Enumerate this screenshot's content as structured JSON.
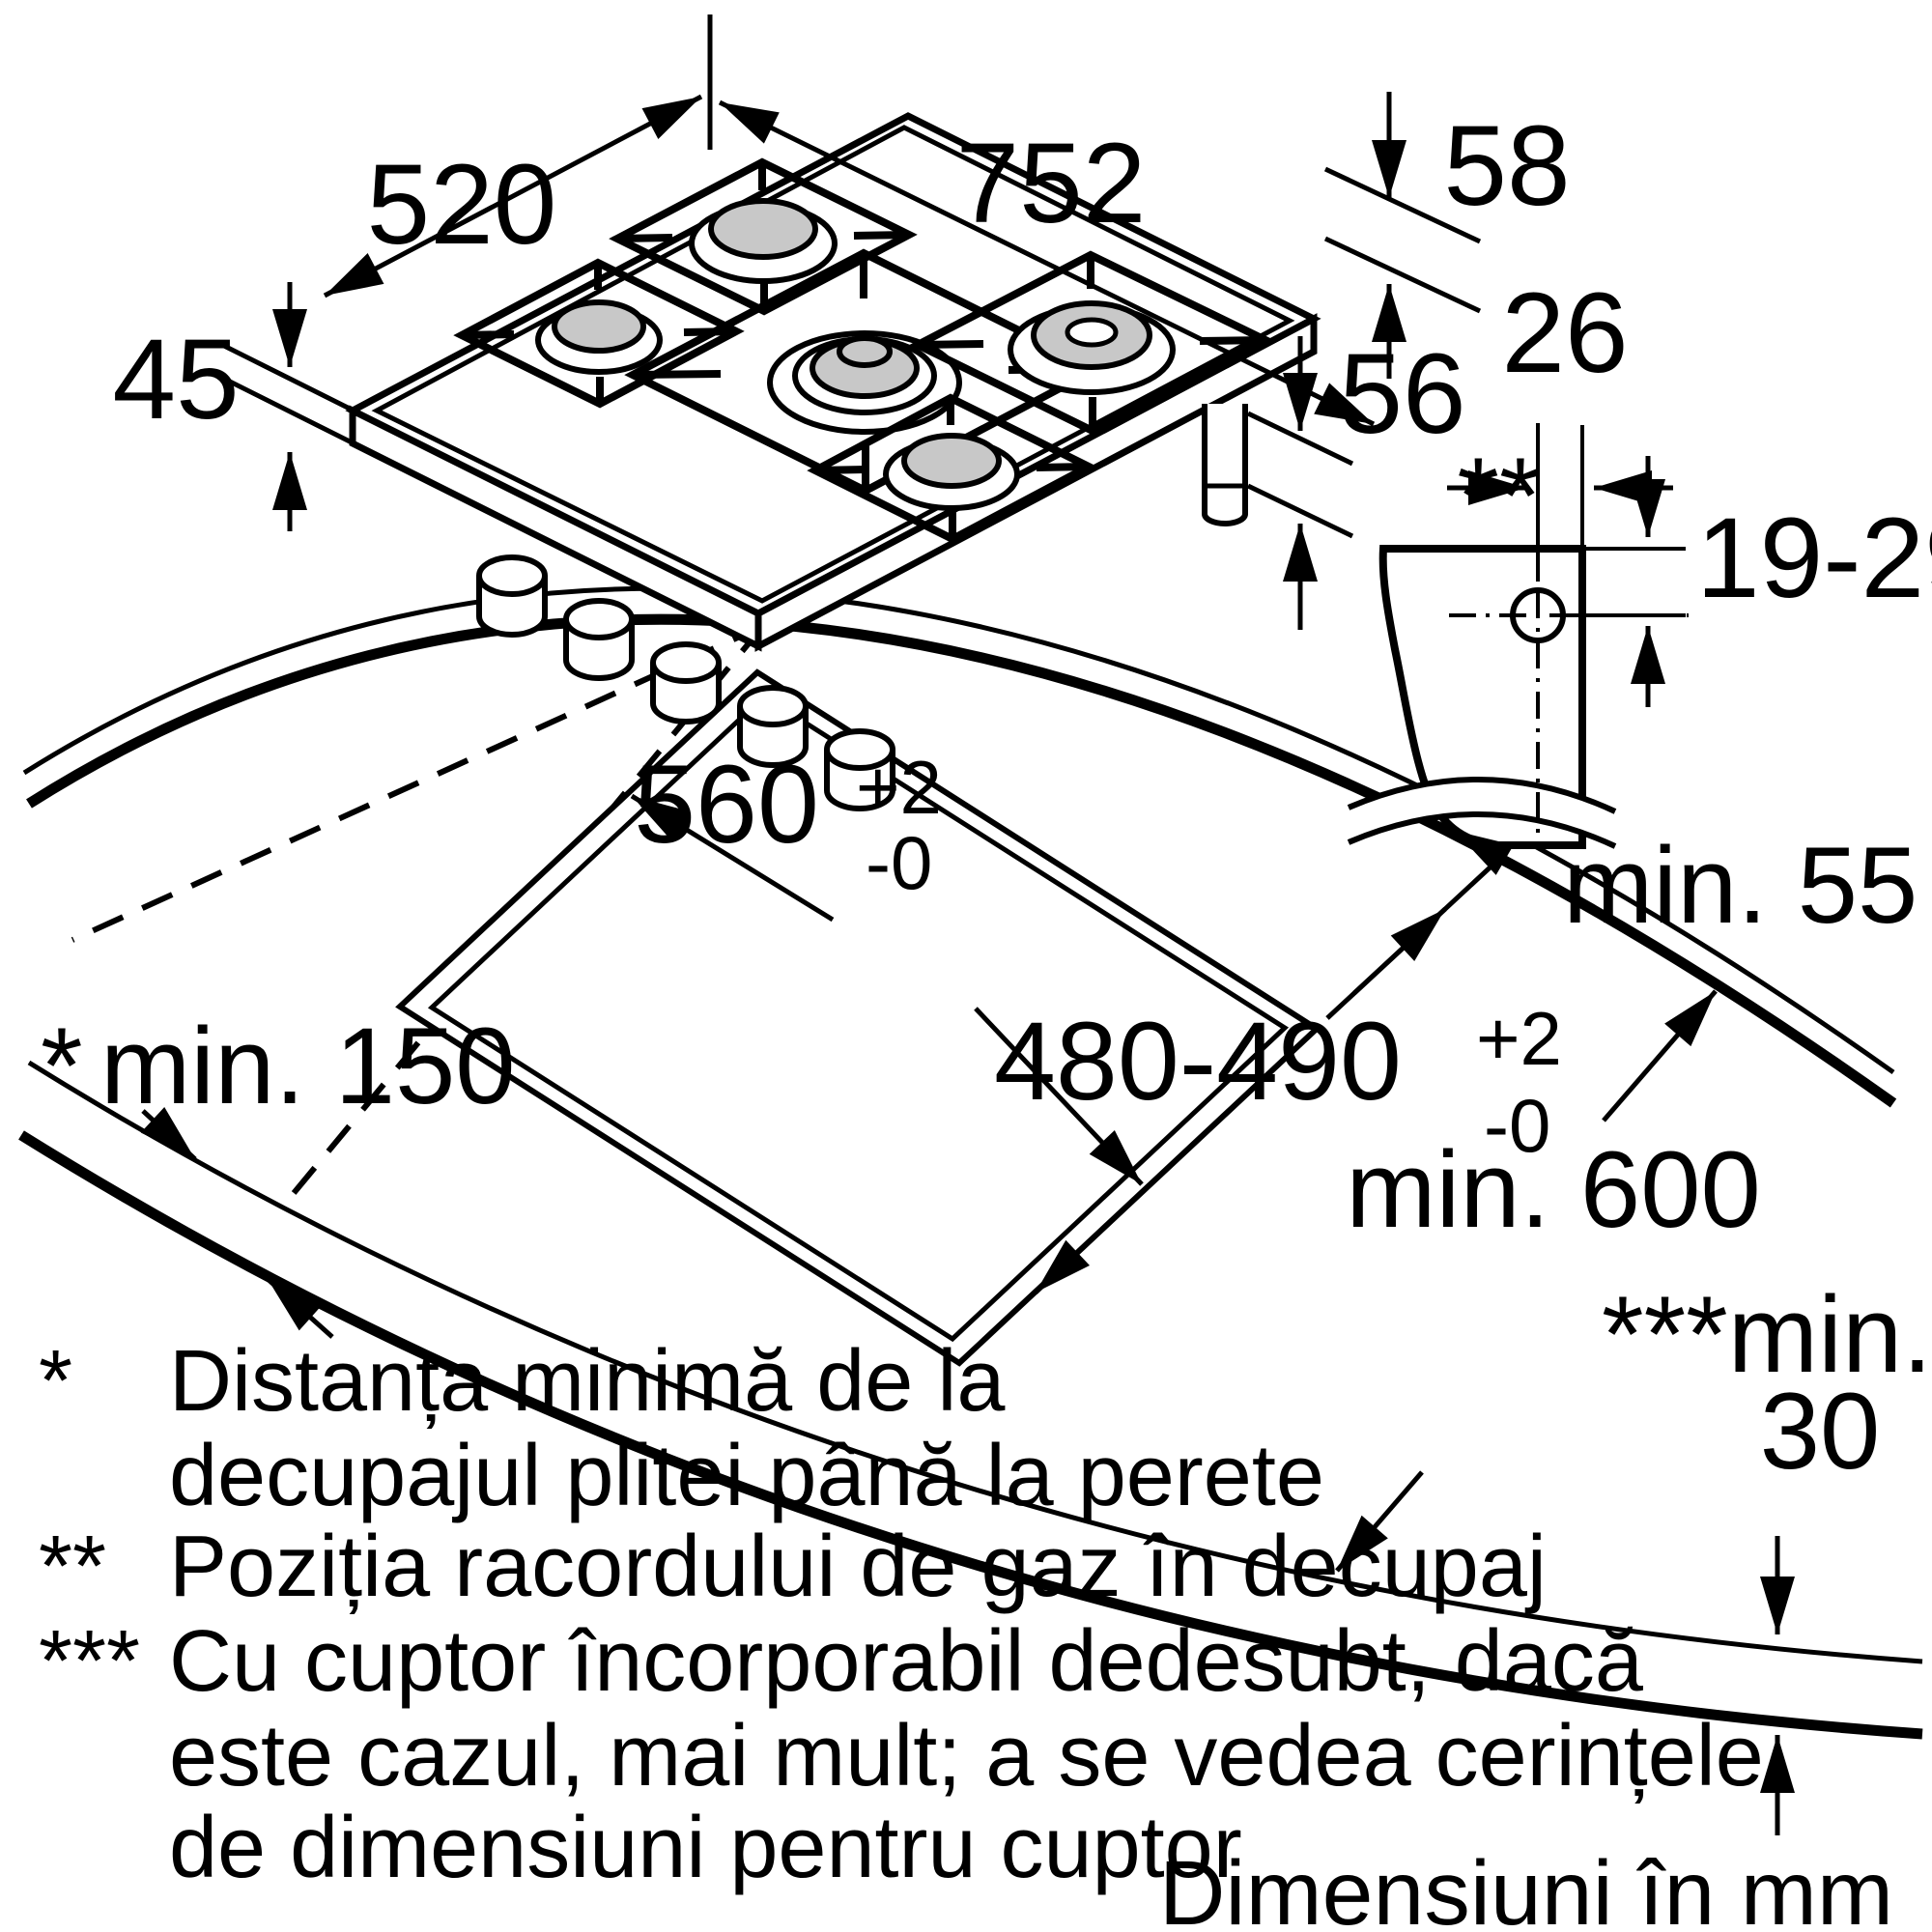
{
  "diagram": {
    "units_note": "Dimensiuni în mm",
    "dims": {
      "hob_width": "752",
      "hob_depth": "520",
      "hob_height": "45",
      "rear_edge_offset": "58",
      "connector_drop": "56",
      "connector_offset": "26",
      "connector_range": "19-29",
      "connector_marker": "**",
      "cutout_width": "560",
      "cutout_width_tol_plus": "+2",
      "cutout_width_tol_minus": "-0",
      "cutout_depth": "480-490",
      "cutout_depth_tol_plus": "+2",
      "cutout_depth_tol_minus": "-0",
      "wall_marker": "*",
      "wall_clearance": "min. 150",
      "rear_clearance": "min. 55",
      "worktop_depth": "min. 600",
      "oven_marker": "***",
      "oven_clearance_label": "min.",
      "oven_clearance_value": "30"
    },
    "footnotes": [
      {
        "marker": "*",
        "lines": [
          "Distanța minimă de la",
          "decupajul plitei până la perete"
        ]
      },
      {
        "marker": "**",
        "lines": [
          "Poziția racordului de gaz în decupaj"
        ]
      },
      {
        "marker": "***",
        "lines": [
          "Cu cuptor încorporabil dedesubt, dacă",
          "este cazul, mai mult; a se vedea cerințele",
          "de dimensiuni pentru cuptor"
        ]
      }
    ],
    "colors": {
      "line": "#000000",
      "burner_fill": "#c8c8c8",
      "background": "#ffffff"
    }
  }
}
